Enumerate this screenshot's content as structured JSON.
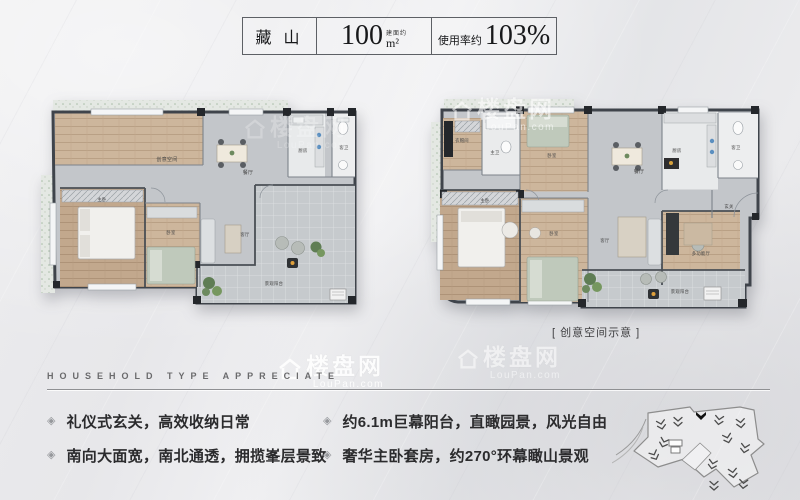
{
  "header": {
    "project_name": "藏 山",
    "area_prefix": "建面约",
    "area_value": "100",
    "area_unit": "m²",
    "usage_prefix": "使用率约",
    "usage_value": "103%"
  },
  "plans": {
    "left": {
      "rooms": [
        {
          "label": "创意空间"
        },
        {
          "label": "餐厅"
        },
        {
          "label": "厨房"
        },
        {
          "label": "客卫"
        },
        {
          "label": "主卧"
        },
        {
          "label": "卧室"
        },
        {
          "label": "客厅"
        },
        {
          "label": "景观阳台"
        }
      ]
    },
    "right": {
      "rooms": [
        {
          "label": "衣帽间"
        },
        {
          "label": "主卫"
        },
        {
          "label": "卧室"
        },
        {
          "label": "餐厅"
        },
        {
          "label": "厨房"
        },
        {
          "label": "客卫"
        },
        {
          "label": "玄关"
        },
        {
          "label": "主卧"
        },
        {
          "label": "卧室"
        },
        {
          "label": "客厅"
        },
        {
          "label": "多功能厅"
        },
        {
          "label": "景观阳台"
        }
      ],
      "caption": "[ 创意空间示意 ]"
    }
  },
  "section": {
    "title": "HOUSEHOLD TYPE APPRECIATE",
    "bullet": "◈",
    "features_left": [
      "礼仪式玄关，高效收纳日常",
      "南向大面宽，南北通透，拥揽峯层景致"
    ],
    "features_right": [
      "约6.1m巨幕阳台，直瞰园景，风光自由",
      "奢华主卧套房，约270°环幕瞰山景观"
    ]
  },
  "watermark": {
    "name": "楼盘网",
    "domain": "LouPan.com"
  },
  "colors": {
    "wood": "#c6ae94",
    "tile": "#c7cbce",
    "wall": "#3f444b"
  }
}
